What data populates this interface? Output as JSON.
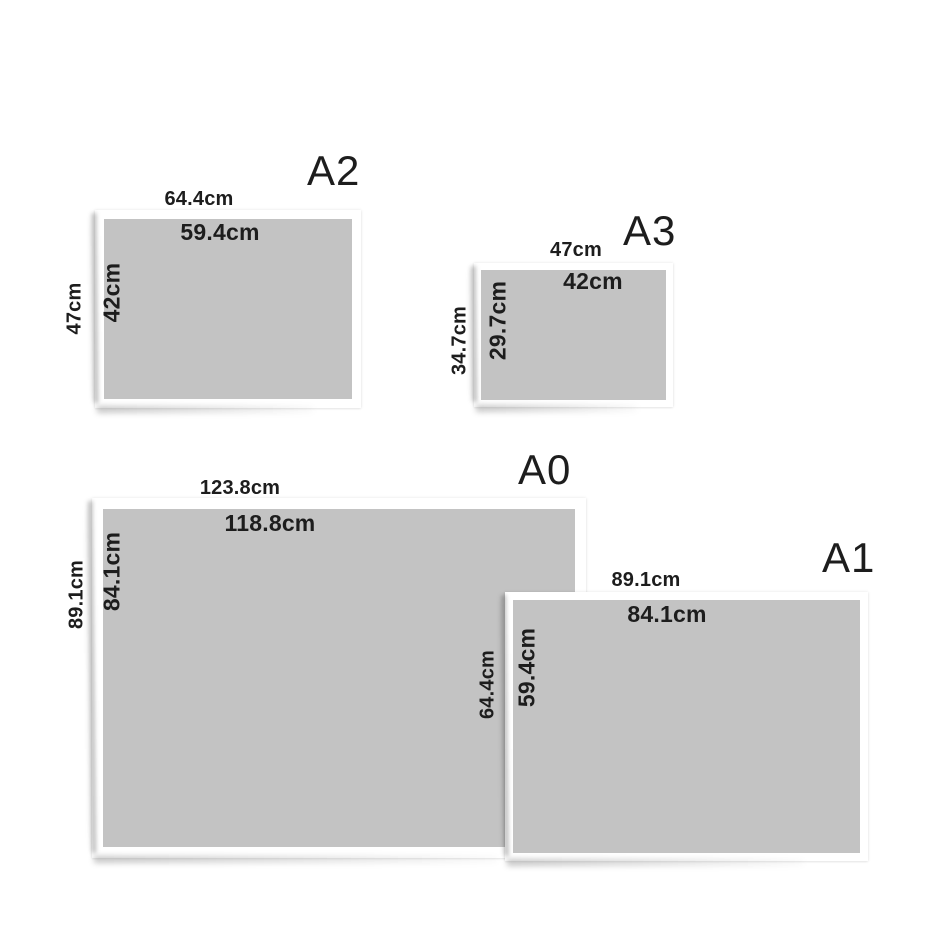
{
  "colors": {
    "background": "#ffffff",
    "paper_frame": "#ffffff",
    "paper_inner": "#c3c3c3",
    "text": "#1d1d1d"
  },
  "papers": [
    {
      "name": "A2",
      "outer_width": "64.4cm",
      "inner_width": "59.4cm",
      "outer_height": "47cm",
      "inner_height": "42cm"
    },
    {
      "name": "A3",
      "outer_width": "47cm",
      "inner_width": "42cm",
      "outer_height": "34.7cm",
      "inner_height": "29.7cm"
    },
    {
      "name": "A0",
      "outer_width": "123.8cm",
      "inner_width": "118.8cm",
      "outer_height": "89.1cm",
      "inner_height": "84.1cm"
    },
    {
      "name": "A1",
      "outer_width": "89.1cm",
      "inner_width": "84.1cm",
      "outer_height": "64.4cm",
      "inner_height": "59.4cm"
    }
  ]
}
